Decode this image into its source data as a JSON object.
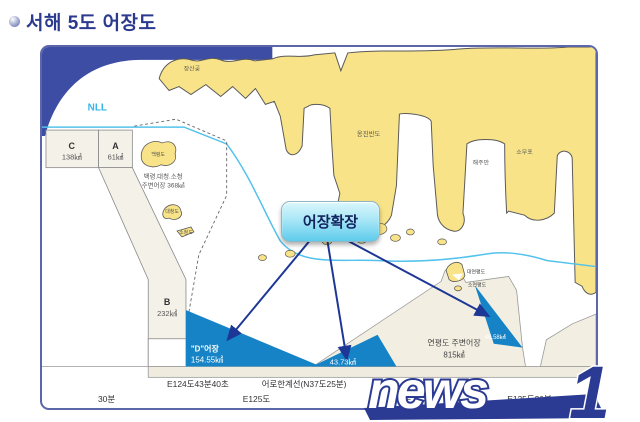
{
  "title": "서해 5도 어장도",
  "colors": {
    "land": "#f8e388",
    "sea": "#ffffff",
    "nll_line": "#35b4e6",
    "zone_fill": "#f4f1e8",
    "expansion_triangle": "#1583c5",
    "frame_blue": "#3d4da3",
    "callout_cyan": "#5ecbec",
    "title_navy": "#2b3a8e",
    "watermark_navy": "#2b3a92"
  },
  "map": {
    "nll": "NLL",
    "zone_c_name": "C",
    "zone_c_area": "138㎢",
    "zone_a_name": "A",
    "zone_a_area": "61㎢",
    "zone_b_name": "B",
    "zone_b_area": "232㎢",
    "jangsangot": "장산곶",
    "ongjin_peninsula": "옹진반도",
    "haeju_bay": "해주만",
    "somupo": "소무포",
    "baengnyeongdo": "백령도",
    "daecheongdo": "대청도",
    "socheongdo": "소청도",
    "bdsc_line1": "백령.대청.소청",
    "bdsc_line2": "주변어장 368㎢",
    "daeyeonpyeongdo": "대연평도",
    "soyeonpyeongdo": "소연평도",
    "yeonpyeong_line1": "연평도 주변어장",
    "yeonpyeong_line2": "815㎢",
    "callout": "어장확장",
    "d_zone_name": "\"D\"어장",
    "d_zone_area": "154.55㎢",
    "mid_area": "43.73㎢",
    "right_area": "46.58㎢",
    "e124": "E124도43분40초",
    "fishing_limit": "어로한계선(N37도25분)",
    "min30_left": "30분",
    "e125": "E125도",
    "min30_right": "30분",
    "e125_30": "E125도30분"
  },
  "watermark": {
    "news": "news",
    "one": "1"
  }
}
